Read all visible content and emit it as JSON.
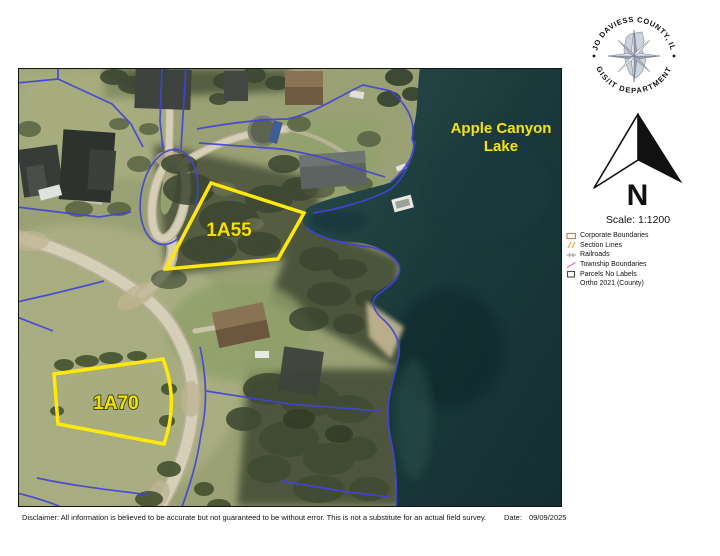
{
  "seal": {
    "top_text": "JO DAVIESS COUNTY, IL",
    "bottom_text": "GIS/IT DEPARTMENT"
  },
  "north_arrow": {
    "label": "N"
  },
  "scale": {
    "text": "Scale: 1:1200"
  },
  "legend": {
    "items": [
      {
        "label": "Corporate Boundaries",
        "icon": "corporate-boundaries-icon",
        "color": "#b98a62"
      },
      {
        "label": "Section Lines",
        "icon": "section-lines-icon",
        "color": "#f0a53c"
      },
      {
        "label": "Railroads",
        "icon": "railroads-icon",
        "color": "#9a9a9a"
      },
      {
        "label": "Township Boundaries",
        "icon": "township-boundaries-icon",
        "color": "#f080c0"
      },
      {
        "label": "Parcels No Labels",
        "icon": "parcels-no-labels-icon",
        "color": "#4a4a4a"
      }
    ],
    "basemap_note": "Ortho 2021 (County)"
  },
  "map": {
    "lake_label": {
      "text": "Apple Canyon Lake",
      "lines": [
        "Apple Canyon",
        "Lake"
      ],
      "color": "#f2e41c"
    },
    "parcels": [
      {
        "id": "1A55"
      },
      {
        "id": "1A70"
      }
    ],
    "colors": {
      "parcel_highlight": "#ffe80a",
      "parcel_lines": "#4343d8",
      "water": "#1b3a3c",
      "label_yellow": "#f2e41c"
    }
  },
  "footer": {
    "disclaimer": "Disclaimer: All information is believed to be accurate but not guaranteed to be without error. This is not a substitute for an actual field survey.",
    "date_label": "Date:",
    "date_value": "09/09/2025"
  }
}
